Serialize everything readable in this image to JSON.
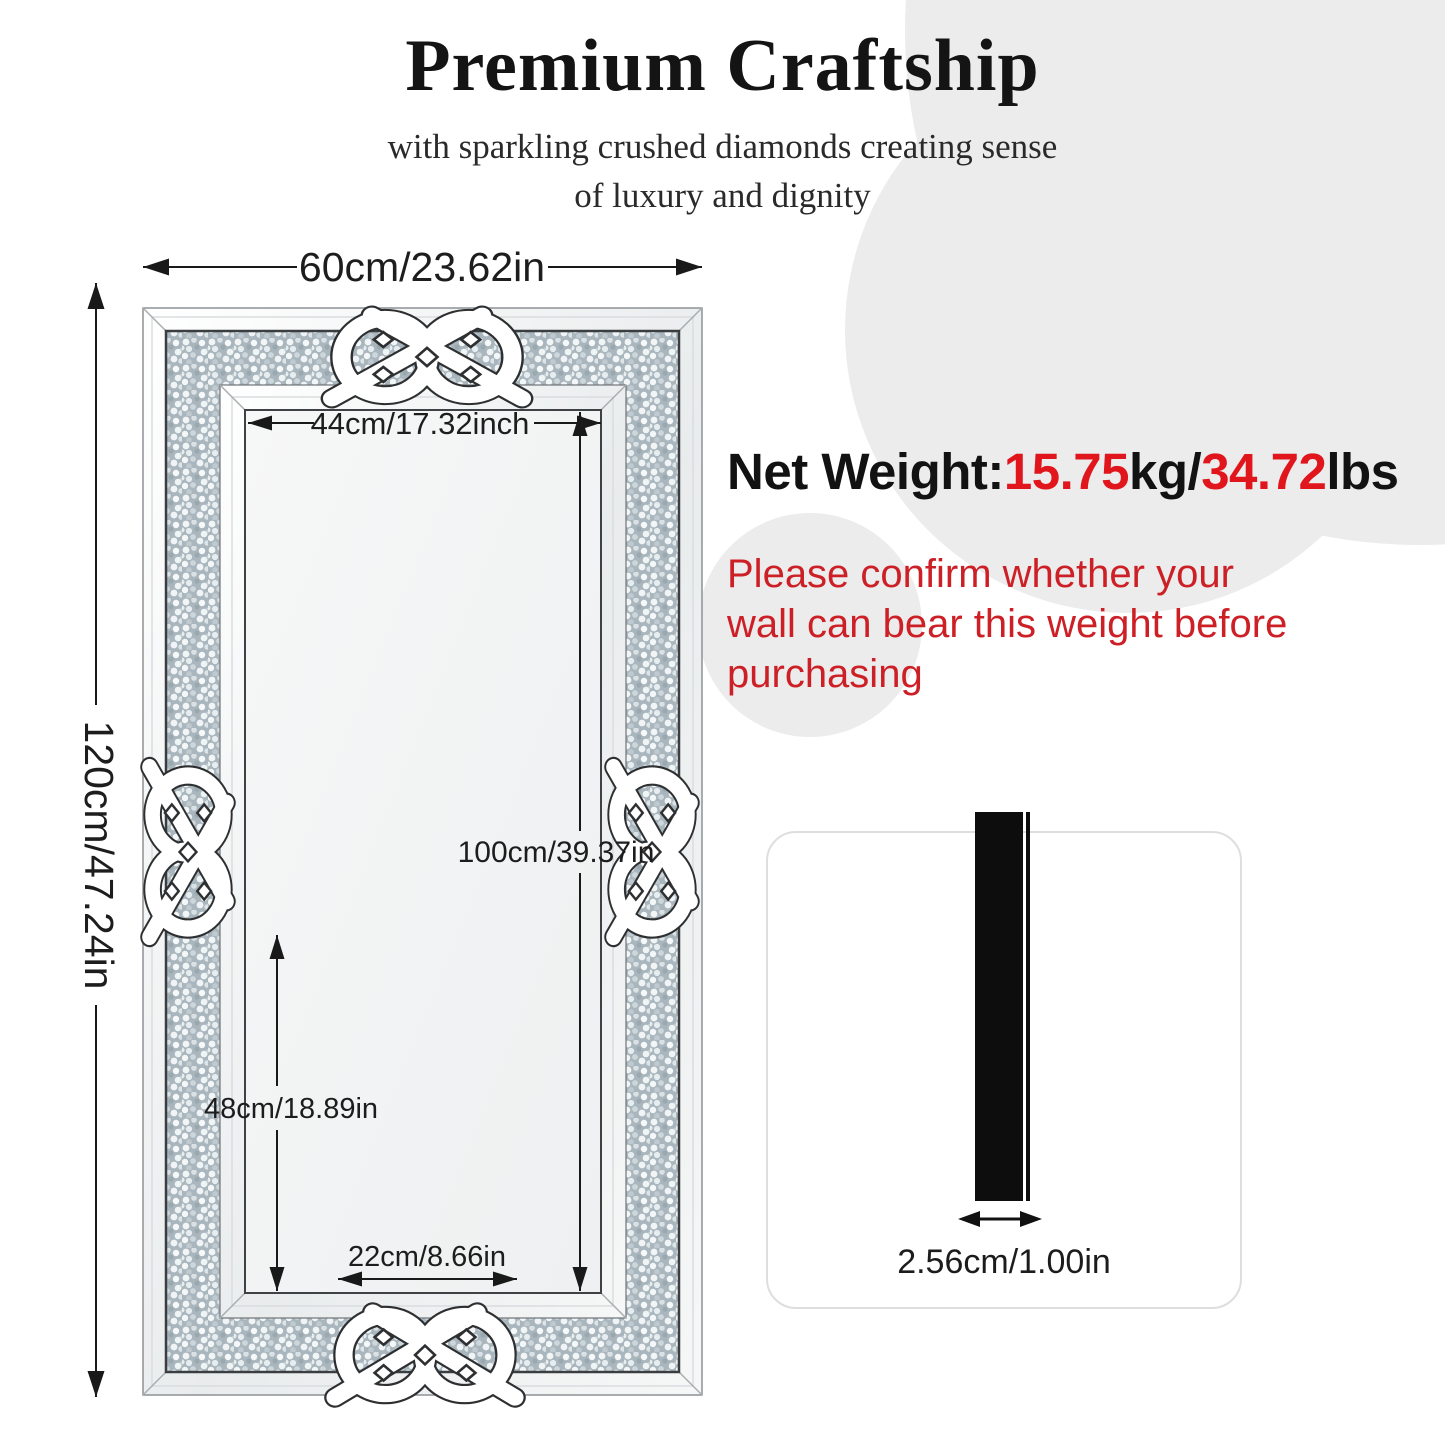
{
  "header": {
    "title": "Premium Craftship",
    "subtitle_line1": "with sparkling crushed diamonds creating sense",
    "subtitle_line2": "of luxury and dignity"
  },
  "mirror": {
    "outer_width_label": "60cm/23.62in",
    "outer_height_label": "120cm/47.24in",
    "inner_width_label": "44cm/17.32inch",
    "inner_height_label": "100cm/39.37in",
    "lower_height_label": "48cm/18.89in",
    "bottom_width_label": "22cm/8.66in"
  },
  "weight": {
    "label": "Net Weight:",
    "kg_value": "15.75",
    "kg_unit": "kg/",
    "lbs_value": "34.72",
    "lbs_unit": "lbs",
    "value_color": "#e0161c"
  },
  "warning": {
    "line1": "Please confirm whether your",
    "line2": "wall can bear this weight before",
    "line3": "purchasing",
    "color": "#cd2026"
  },
  "side_view": {
    "thickness_label": "2.56cm/1.00in"
  },
  "colors": {
    "background_circle": "#ececec",
    "diamond_band_base": "#aab6bd"
  }
}
